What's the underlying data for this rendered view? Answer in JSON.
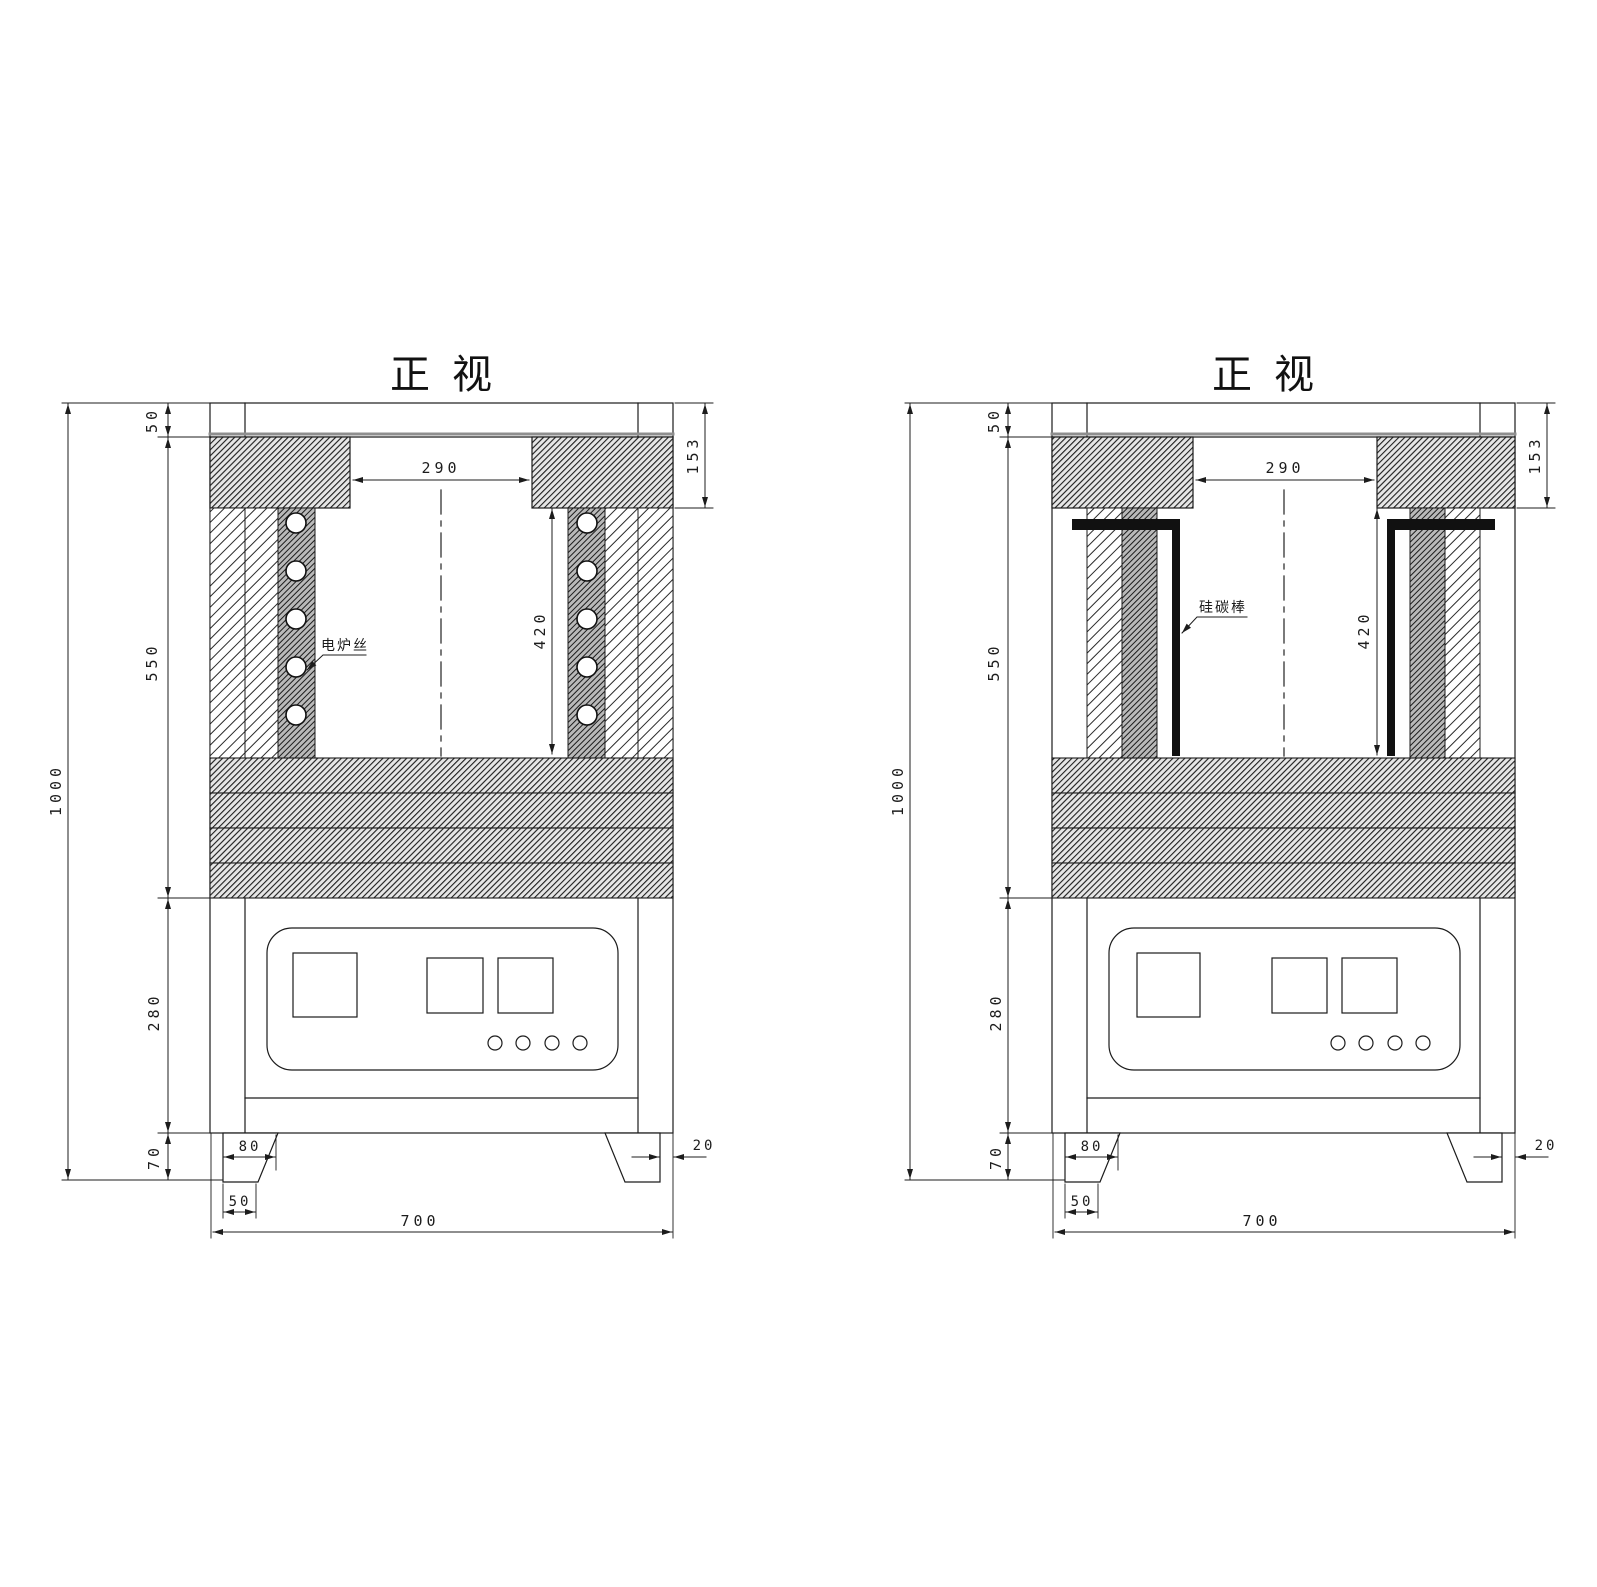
{
  "document": {
    "type": "engineering-drawing",
    "background": "#ffffff",
    "line_color": "#1c1c1c",
    "accent_grey": "#8f8f8f"
  },
  "drawings": [
    {
      "id": "front-view-heating-wire",
      "title": "正视",
      "annotation": "电炉丝",
      "dims": {
        "total_height": "1000",
        "shell_top": "50",
        "furnace_body": "550",
        "cabinet_height": "280",
        "leg_height": "70",
        "opening_width": "290",
        "lid_height": "153",
        "chamber_height": "420",
        "leg_top_width": "80",
        "leg_bottom_width": "50",
        "base_width": "700",
        "leg_inset": "20"
      }
    },
    {
      "id": "front-view-sic-rod",
      "title": "正视",
      "annotation": "硅碳棒",
      "dims": {
        "total_height": "1000",
        "shell_top": "50",
        "furnace_body": "550",
        "cabinet_height": "280",
        "leg_height": "70",
        "opening_width": "290",
        "lid_height": "153",
        "chamber_height": "420",
        "leg_top_width": "80",
        "leg_bottom_width": "50",
        "base_width": "700",
        "leg_inset": "20"
      }
    }
  ]
}
